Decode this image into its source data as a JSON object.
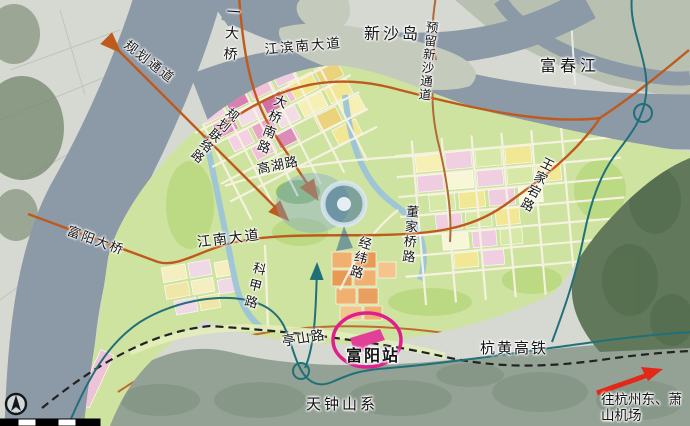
{
  "map": {
    "labels": {
      "bridge_no1": "一大桥",
      "xinsha_island": "新沙岛",
      "reserved_xinsha_channel": "预留新沙通道",
      "fuchun_river": "富春江",
      "jiangbin_south_avenue": "江滨南大道",
      "planned_corridor": "规划通道",
      "daqiao_south_road": "大桥南路",
      "planned_link_road": "规划联络路",
      "gaohu_road": "高湖路",
      "fuyang_bridge": "富阳大桥",
      "jiangnan_avenue": "江南大道",
      "kejia_road": "科甲路",
      "jingwei_road": "经纬路",
      "dongjiaqiao_road": "董家桥路",
      "wangjiadang_road": "王家宕路",
      "tingshan_road": "亭山路",
      "fuyang_station": "富阳站",
      "hanghuang_hsr": "杭黄高铁",
      "to_hangzhou_east": "往杭州东、萧山机场",
      "tianzhong_mountains": "天钟山系"
    },
    "colors": {
      "river": "#8c99a7",
      "old_city": "#d6d8d2",
      "north_bank": "#b8c0b2",
      "island": "#c4cabc",
      "plan_green": "#cfe3a0",
      "hills_dark": "#61795a",
      "hills_bottom": "#93a294",
      "road_orange": "#bf5a1d",
      "rail_teal": "#20707a",
      "railway_black": "#222222",
      "station_magenta": "#de1f8d",
      "arrow_red": "#e22818",
      "emblem_blue": "#2e5f94"
    }
  }
}
